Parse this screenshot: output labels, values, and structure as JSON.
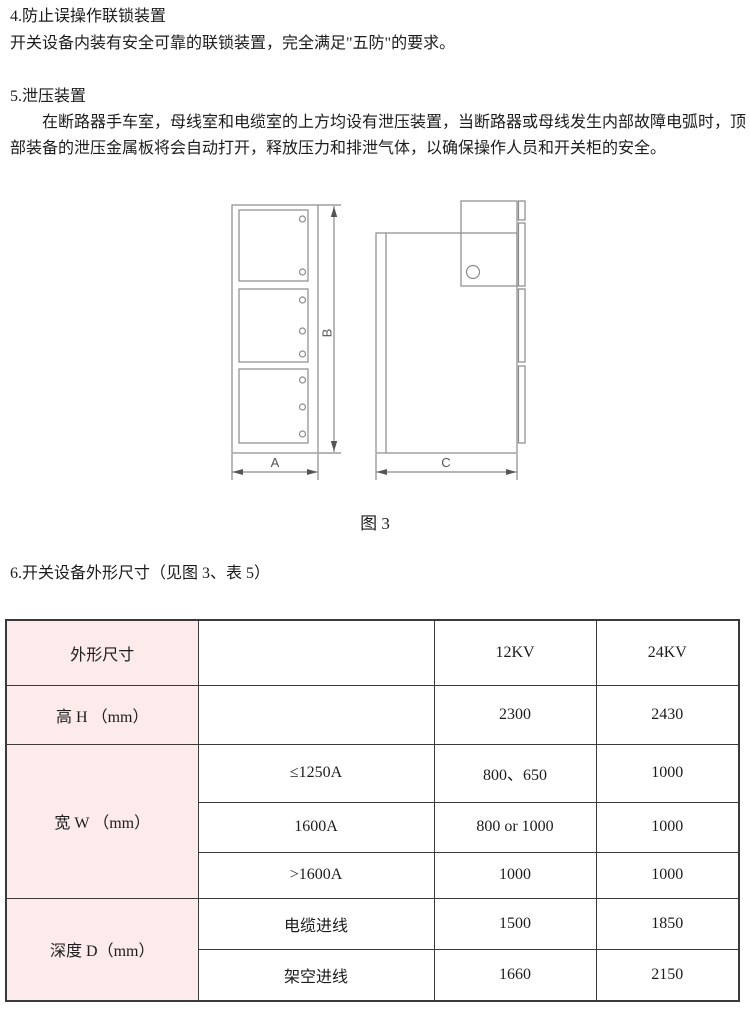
{
  "colors": {
    "table_header_bg": "#fdebeb",
    "table_border": "#3a3a3a",
    "diagram_line": "#8a8a8a",
    "text": "#1c1c1c"
  },
  "section4": {
    "heading": "4.防止误操作联锁装置",
    "body": "开关设备内装有安全可靠的联锁装置，完全满足\"五防\"的要求。"
  },
  "section5": {
    "heading": "5.泄压装置",
    "body_line1": "在断路器手车室，母线室和电缆室的上方均设有泄压装置，当断路器或母线发生内部故障电弧时，顶",
    "body_line2": "部装备的泄压金属板将会自动打开，释放压力和排泄气体，以确保操作人员和开关柜的安全。"
  },
  "figure": {
    "caption": "图 3",
    "dim_a": "A",
    "dim_b": "B",
    "dim_c": "C"
  },
  "section6": {
    "heading": "6.开关设备外形尺寸（见图 3、表 5）"
  },
  "table": {
    "header": {
      "col1": "外形尺寸",
      "v12": "12KV",
      "v24": "24KV"
    },
    "rows": {
      "height": {
        "label": "高 H （mm）",
        "v12": "2300",
        "v24": "2430"
      },
      "width": {
        "label": "宽 W （mm）",
        "sub": [
          {
            "cond": "≤1250A",
            "v12": "800、650",
            "v24": "1000"
          },
          {
            "cond": "1600A",
            "v12": "800 or 1000",
            "v24": "1000"
          },
          {
            "cond": ">1600A",
            "v12": "1000",
            "v24": "1000"
          }
        ]
      },
      "depth": {
        "label": "深度 D（mm）",
        "sub": [
          {
            "cond": "电缆进线",
            "v12": "1500",
            "v24": "1850"
          },
          {
            "cond": "架空进线",
            "v12": "1660",
            "v24": "2150"
          }
        ]
      }
    }
  }
}
